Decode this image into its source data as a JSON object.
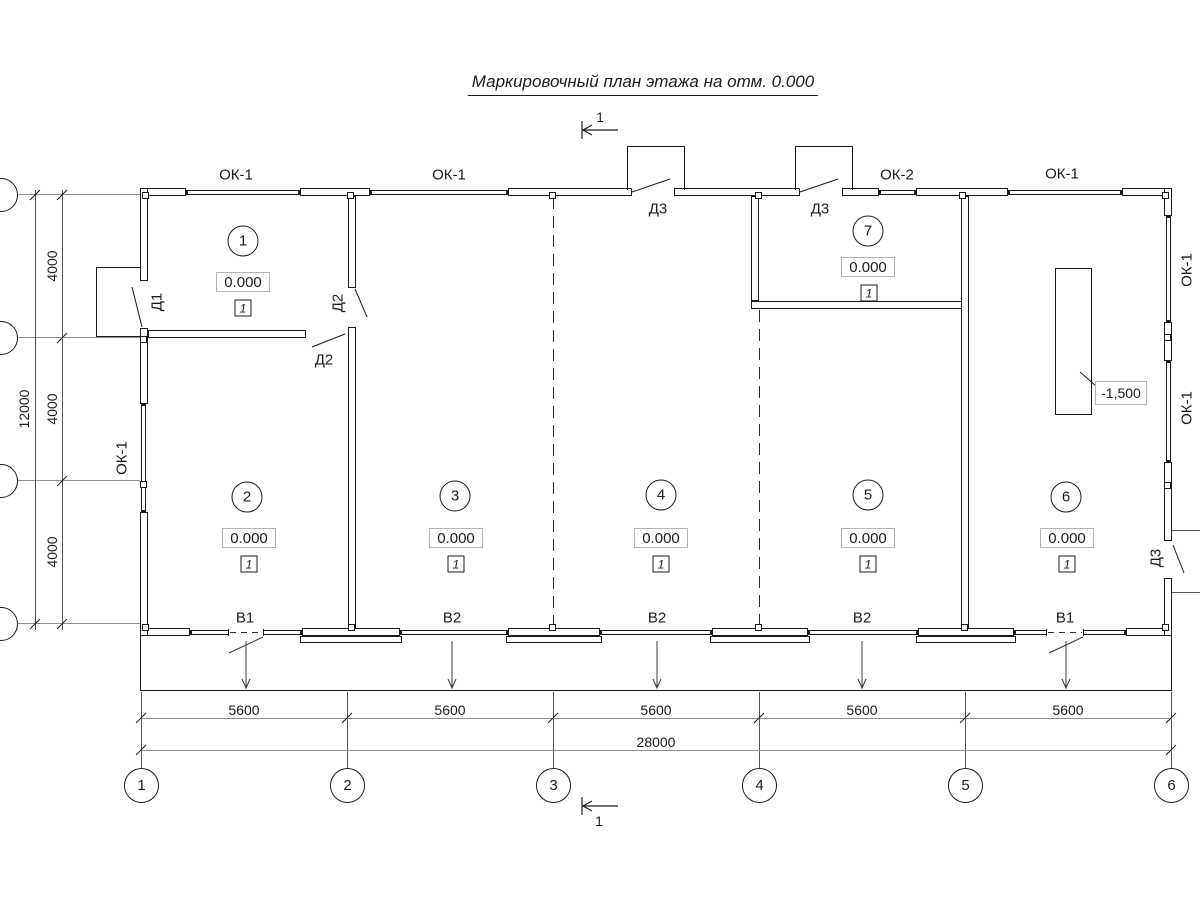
{
  "title": "Маркировочный план этажа на отм. 0.000",
  "section_mark": "1",
  "labels": {
    "ok1": "ОК-1",
    "ok2": "ОК-2",
    "d1": "Д1",
    "d2": "Д2",
    "d3": "Д3",
    "v1": "В1",
    "v2": "В2"
  },
  "rooms": [
    {
      "n": "1",
      "e": "0.000",
      "f": "1"
    },
    {
      "n": "2",
      "e": "0.000",
      "f": "1"
    },
    {
      "n": "3",
      "e": "0.000",
      "f": "1"
    },
    {
      "n": "4",
      "e": "0.000",
      "f": "1"
    },
    {
      "n": "5",
      "e": "0.000",
      "f": "1"
    },
    {
      "n": "6",
      "e": "0.000",
      "f": "1"
    },
    {
      "n": "7",
      "e": "0.000",
      "f": "1"
    }
  ],
  "pit": {
    "elev": "-1,500"
  },
  "dims": {
    "bay": "5600",
    "total": "28000",
    "row": "4000",
    "rows_total": "12000"
  },
  "axes": [
    "1",
    "2",
    "3",
    "4",
    "5",
    "6"
  ]
}
